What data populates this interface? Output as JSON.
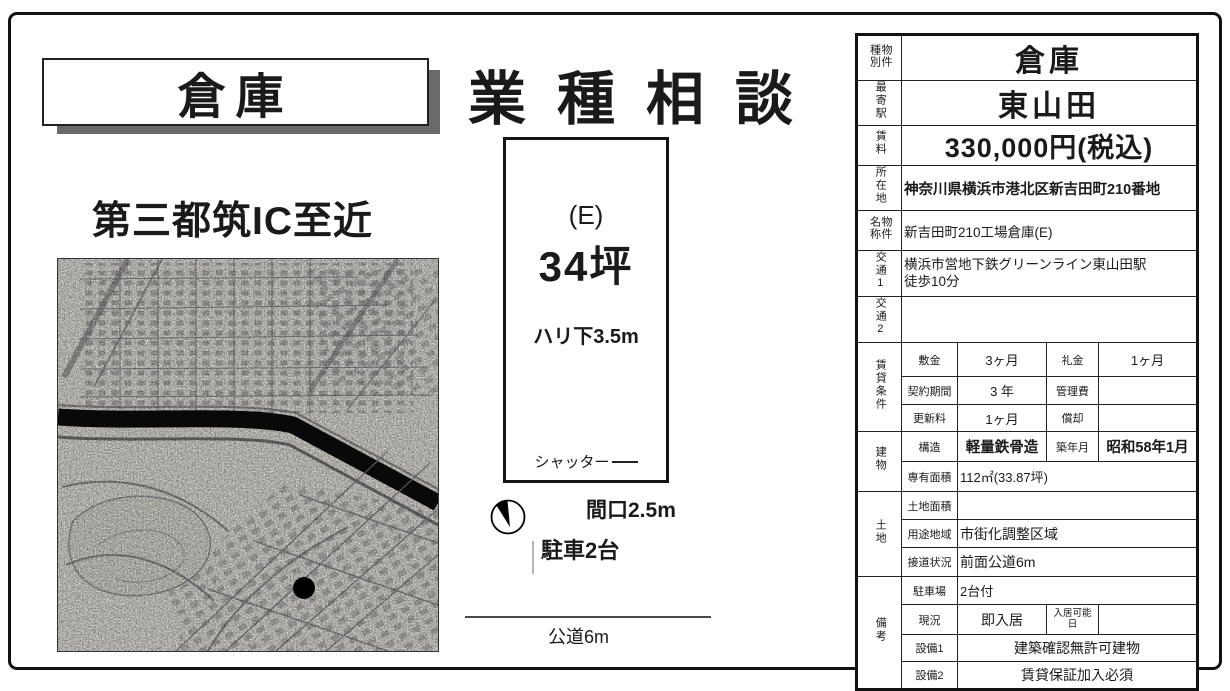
{
  "header": {
    "warehouse_title": "倉庫",
    "main_title": "業種相談",
    "subtitle": "第三都筑IC至近"
  },
  "floorplan": {
    "unit": "(E)",
    "size": "34坪",
    "ceiling": "ハリ下3.5m",
    "shutter": "シャッター",
    "frontage": "間口2.5m",
    "parking": "駐車2台",
    "road": "公道6m"
  },
  "icons": {
    "compass": "north-compass",
    "marker": "location-dot"
  },
  "spec_table": {
    "property_type_label": "物件種別",
    "property_type_value": "倉庫",
    "station_label": "最寄駅",
    "station_value": "東山田",
    "rent_label": "賃料",
    "rent_value": "330,000円(税込)",
    "address_label": "所在地",
    "address_value": "神奈川県横浜市港北区新吉田町210番地",
    "name_label": "物件名称",
    "name_value": "新吉田町210工場倉庫(E)",
    "access1_label": "交通1",
    "access1_value_line1": "横浜市営地下鉄グリーンライン東山田駅",
    "access1_value_line2": "徒歩10分",
    "access2_label": "交通2",
    "access2_value": "",
    "lease_group_label": "賃貸条件",
    "deposit_label": "敷金",
    "deposit_value": "3ヶ月",
    "key_money_label": "礼金",
    "key_money_value": "1ヶ月",
    "contract_period_label": "契約期間",
    "contract_period_value": "3 年",
    "management_fee_label": "管理費",
    "management_fee_value": "",
    "renewal_fee_label": "更新料",
    "renewal_fee_value": "1ヶ月",
    "amortization_label": "償却",
    "amortization_value": "",
    "building_group_label": "建物",
    "structure_label": "構造",
    "structure_value": "軽量鉄骨造",
    "built_date_label": "築年月",
    "built_date_value": "昭和58年1月",
    "floor_area_label": "専有面積",
    "floor_area_value": "112㎡(33.87坪)",
    "land_group_label": "土地",
    "land_area_label": "土地面積",
    "land_area_value": "",
    "zoning_label": "用途地域",
    "zoning_value": "市街化調整区域",
    "road_contact_label": "接道状況",
    "road_contact_value": "前面公道6m",
    "notes_group_label": "備考",
    "parking_label": "駐車場",
    "parking_value": "2台付",
    "current_status_label": "現況",
    "current_status_value": "即入居",
    "movein_date_label": "入居可能日",
    "movein_date_value": "",
    "equipment1_label": "設備1",
    "equipment1_value": "建築確認無許可建物",
    "equipment2_label": "設備2",
    "equipment2_value": "賃貸保証加入必須"
  },
  "colors": {
    "ink": "#1a1a1a",
    "shadow": "#6a6a6a",
    "river": "#0d0d0d",
    "map_bg": "#f1efe9"
  }
}
